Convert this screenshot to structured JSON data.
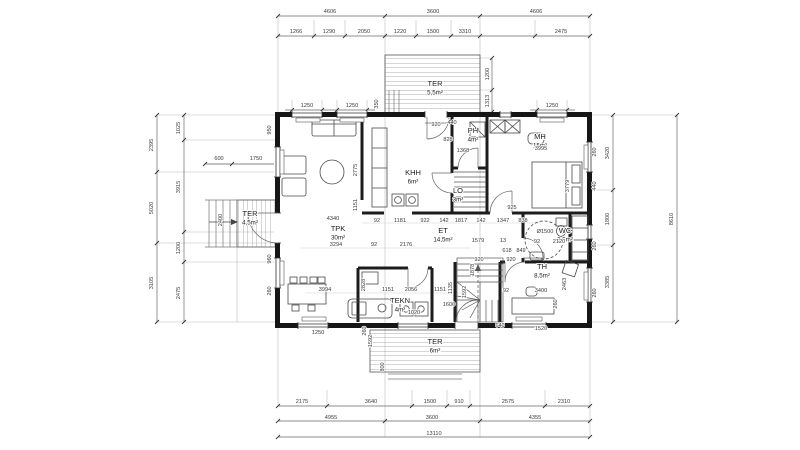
{
  "drawing_title": "floor-plan",
  "rooms": [
    {
      "name": "TPK",
      "area": "30m²",
      "x": 338,
      "y": 231
    },
    {
      "name": "KHH",
      "area": "6m²",
      "x": 413,
      "y": 175
    },
    {
      "name": "PH",
      "area": "4m²",
      "x": 473,
      "y": 133
    },
    {
      "name": "MH",
      "area": "15m²",
      "x": 540,
      "y": 139
    },
    {
      "name": "ET",
      "area": "14,5m²",
      "x": 443,
      "y": 233
    },
    {
      "name": "WC",
      "area": "3,5m²",
      "x": 565,
      "y": 233
    },
    {
      "name": "TH",
      "area": "8,5m²",
      "x": 542,
      "y": 269
    },
    {
      "name": "TEKN",
      "area": "4m²",
      "x": 400,
      "y": 303
    },
    {
      "name": "LO",
      "area": "3m²",
      "x": 458,
      "y": 193
    },
    {
      "name": "TER",
      "area": "5,5m²",
      "x": 435,
      "y": 86
    },
    {
      "name": "TER",
      "area": "4,5m²",
      "x": 250,
      "y": 216
    },
    {
      "name": "TER",
      "area": "6m²",
      "x": 435,
      "y": 344
    }
  ],
  "dims": [
    {
      "t": "4606",
      "x": 330,
      "y": 13
    },
    {
      "t": "3600",
      "x": 433,
      "y": 13
    },
    {
      "t": "4606",
      "x": 536,
      "y": 13
    },
    {
      "t": "1266",
      "x": 296,
      "y": 33
    },
    {
      "t": "1290",
      "x": 329,
      "y": 33
    },
    {
      "t": "2050",
      "x": 364,
      "y": 33
    },
    {
      "t": "1220",
      "x": 400,
      "y": 33
    },
    {
      "t": "1500",
      "x": 433,
      "y": 33
    },
    {
      "t": "3310",
      "x": 465,
      "y": 33
    },
    {
      "t": "2475",
      "x": 561,
      "y": 33
    },
    {
      "t": "1250",
      "x": 307,
      "y": 107
    },
    {
      "t": "1250",
      "x": 352,
      "y": 107
    },
    {
      "t": "350",
      "x": 378,
      "y": 104,
      "r": 1
    },
    {
      "t": "920",
      "x": 436,
      "y": 126
    },
    {
      "t": "440",
      "x": 452,
      "y": 124
    },
    {
      "t": "1250",
      "x": 552,
      "y": 107
    },
    {
      "t": "1200",
      "x": 489,
      "y": 74,
      "r": 1
    },
    {
      "t": "1313",
      "x": 489,
      "y": 101,
      "r": 1
    },
    {
      "t": "2395",
      "x": 153,
      "y": 145,
      "r": 1
    },
    {
      "t": "5020",
      "x": 153,
      "y": 208,
      "r": 1
    },
    {
      "t": "3105",
      "x": 153,
      "y": 283,
      "r": 1
    },
    {
      "t": "1025",
      "x": 180,
      "y": 128,
      "r": 1
    },
    {
      "t": "3915",
      "x": 180,
      "y": 187,
      "r": 1
    },
    {
      "t": "1200",
      "x": 180,
      "y": 248,
      "r": 1
    },
    {
      "t": "2475",
      "x": 180,
      "y": 293,
      "r": 1
    },
    {
      "t": "950",
      "x": 271,
      "y": 130,
      "r": 1
    },
    {
      "t": "600",
      "x": 219,
      "y": 160
    },
    {
      "t": "1750",
      "x": 256,
      "y": 160
    },
    {
      "t": "2400",
      "x": 222,
      "y": 220,
      "r": 1
    },
    {
      "t": "960",
      "x": 271,
      "y": 259,
      "r": 1
    },
    {
      "t": "260",
      "x": 271,
      "y": 291,
      "r": 1
    },
    {
      "t": "3420",
      "x": 609,
      "y": 153,
      "r": 1
    },
    {
      "t": "1800",
      "x": 609,
      "y": 219,
      "r": 1
    },
    {
      "t": "3385",
      "x": 609,
      "y": 282,
      "r": 1
    },
    {
      "t": "8610",
      "x": 673,
      "y": 219,
      "r": 1
    },
    {
      "t": "260",
      "x": 596,
      "y": 152,
      "r": 1
    },
    {
      "t": "440",
      "x": 596,
      "y": 186,
      "r": 1
    },
    {
      "t": "260",
      "x": 596,
      "y": 246,
      "r": 1
    },
    {
      "t": "260",
      "x": 596,
      "y": 293,
      "r": 1
    },
    {
      "t": "828",
      "x": 448,
      "y": 141
    },
    {
      "t": "1368",
      "x": 463,
      "y": 152
    },
    {
      "t": "3995",
      "x": 541,
      "y": 150
    },
    {
      "t": "3779",
      "x": 569,
      "y": 186,
      "r": 1
    },
    {
      "t": "925",
      "x": 512,
      "y": 209
    },
    {
      "t": "4340",
      "x": 333,
      "y": 220
    },
    {
      "t": "92",
      "x": 377,
      "y": 222
    },
    {
      "t": "1181",
      "x": 400,
      "y": 222
    },
    {
      "t": "922",
      "x": 425,
      "y": 222
    },
    {
      "t": "142",
      "x": 444,
      "y": 222
    },
    {
      "t": "1817",
      "x": 461,
      "y": 222
    },
    {
      "t": "142",
      "x": 481,
      "y": 222
    },
    {
      "t": "1347",
      "x": 503,
      "y": 222
    },
    {
      "t": "838",
      "x": 523,
      "y": 222
    },
    {
      "t": "2775",
      "x": 357,
      "y": 170,
      "r": 1
    },
    {
      "t": "1151",
      "x": 357,
      "y": 205,
      "r": 1
    },
    {
      "t": "3294",
      "x": 336,
      "y": 246
    },
    {
      "t": "92",
      "x": 374,
      "y": 246
    },
    {
      "t": "2176",
      "x": 406,
      "y": 246
    },
    {
      "t": "1579",
      "x": 478,
      "y": 242
    },
    {
      "t": "13",
      "x": 503,
      "y": 242
    },
    {
      "t": "618",
      "x": 507,
      "y": 252
    },
    {
      "t": "849",
      "x": 521,
      "y": 252
    },
    {
      "t": "92",
      "x": 537,
      "y": 243
    },
    {
      "t": "2120",
      "x": 559,
      "y": 243
    },
    {
      "t": "Ø1500",
      "x": 545,
      "y": 233
    },
    {
      "t": "920",
      "x": 479,
      "y": 261
    },
    {
      "t": "920",
      "x": 511,
      "y": 261
    },
    {
      "t": "92",
      "x": 506,
      "y": 292
    },
    {
      "t": "3400",
      "x": 541,
      "y": 292
    },
    {
      "t": "2463",
      "x": 566,
      "y": 284,
      "r": 1
    },
    {
      "t": "260",
      "x": 557,
      "y": 304,
      "r": 1
    },
    {
      "t": "3994",
      "x": 325,
      "y": 291
    },
    {
      "t": "2828",
      "x": 365,
      "y": 285,
      "r": 1
    },
    {
      "t": "1151",
      "x": 388,
      "y": 291
    },
    {
      "t": "2056",
      "x": 411,
      "y": 291
    },
    {
      "t": "1151",
      "x": 440,
      "y": 291
    },
    {
      "t": "1135",
      "x": 452,
      "y": 288,
      "r": 1
    },
    {
      "t": "1878",
      "x": 474,
      "y": 270,
      "r": 1
    },
    {
      "t": "1592",
      "x": 466,
      "y": 292,
      "r": 1
    },
    {
      "t": "1600",
      "x": 449,
      "y": 306
    },
    {
      "t": "1020",
      "x": 414,
      "y": 314
    },
    {
      "t": "1250",
      "x": 318,
      "y": 334
    },
    {
      "t": "260",
      "x": 366,
      "y": 331,
      "r": 1
    },
    {
      "t": "1592",
      "x": 372,
      "y": 341,
      "r": 1
    },
    {
      "t": "800",
      "x": 384,
      "y": 367,
      "r": 1
    },
    {
      "t": "640",
      "x": 500,
      "y": 327
    },
    {
      "t": "1520",
      "x": 541,
      "y": 330
    },
    {
      "t": "2175",
      "x": 302,
      "y": 403
    },
    {
      "t": "3640",
      "x": 371,
      "y": 403
    },
    {
      "t": "1500",
      "x": 430,
      "y": 403
    },
    {
      "t": "910",
      "x": 459,
      "y": 403
    },
    {
      "t": "2575",
      "x": 508,
      "y": 403
    },
    {
      "t": "2310",
      "x": 564,
      "y": 403
    },
    {
      "t": "4955",
      "x": 331,
      "y": 419
    },
    {
      "t": "3600",
      "x": 432,
      "y": 419
    },
    {
      "t": "4355",
      "x": 535,
      "y": 419
    },
    {
      "t": "13110",
      "x": 434,
      "y": 435
    }
  ]
}
